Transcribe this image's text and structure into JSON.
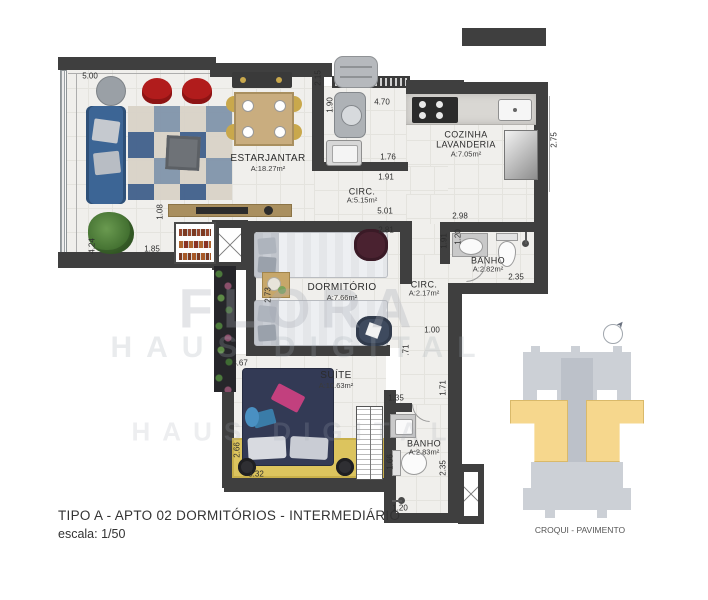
{
  "title_block": {
    "line1": "TIPO A - APTO 02  DORMITÓRIOS - INTERMEDIÁRIO",
    "line2": "escala: 1/50"
  },
  "watermark": {
    "line1": "FLORA",
    "line2": "HAUS DIGITAL",
    "line3": "HAUS DIGITAL"
  },
  "croqui": {
    "label": "CROQUI - PAVIMENTO"
  },
  "rooms": {
    "estar": {
      "name": "ESTARJANTAR",
      "area": "A:18.27m²"
    },
    "cozinha": {
      "name1": "COZINHA",
      "name2": "LAVANDERIA",
      "area": "A:7.05m²"
    },
    "circ1": {
      "name": "CIRC.",
      "area": "A:5.15m²"
    },
    "banho1": {
      "name": "BANHO",
      "area": "A:2.82m²"
    },
    "dormitorio": {
      "name": "DORMITÓRIO",
      "area": "A:7.66m²"
    },
    "circ2": {
      "name": "CIRC.",
      "area": "A:2.17m²"
    },
    "suite": {
      "name": "SUÍTE",
      "area": "A:10.63m²"
    },
    "banho2": {
      "name": "BANHO",
      "area": "A:2.83m²"
    }
  },
  "dims": [
    "5.00",
    "2.15",
    "1.90",
    "4.70",
    "2.75",
    "1.76",
    "1.91",
    "5.01",
    "2.98",
    "2.81",
    "1.91",
    "1.20",
    "2.35",
    "1.08",
    "1.85",
    "4.24",
    "2.73",
    "1.00",
    ".71",
    "3.67",
    "2.66",
    "3.32",
    "1.66",
    "1.35",
    "1.71",
    "2.35",
    "1.20"
  ],
  "colors": {
    "wall": "#3f3f3f",
    "floor": "#f0efec",
    "sofa_blue": "#3c6595",
    "suite_navy": "#333a55",
    "rug_yellow": "#dcc45e",
    "croqui_building_gray": "#ccd0d6",
    "croqui_unit_yellow": "#f6d78d",
    "armchair_red": "#b11c1c"
  }
}
